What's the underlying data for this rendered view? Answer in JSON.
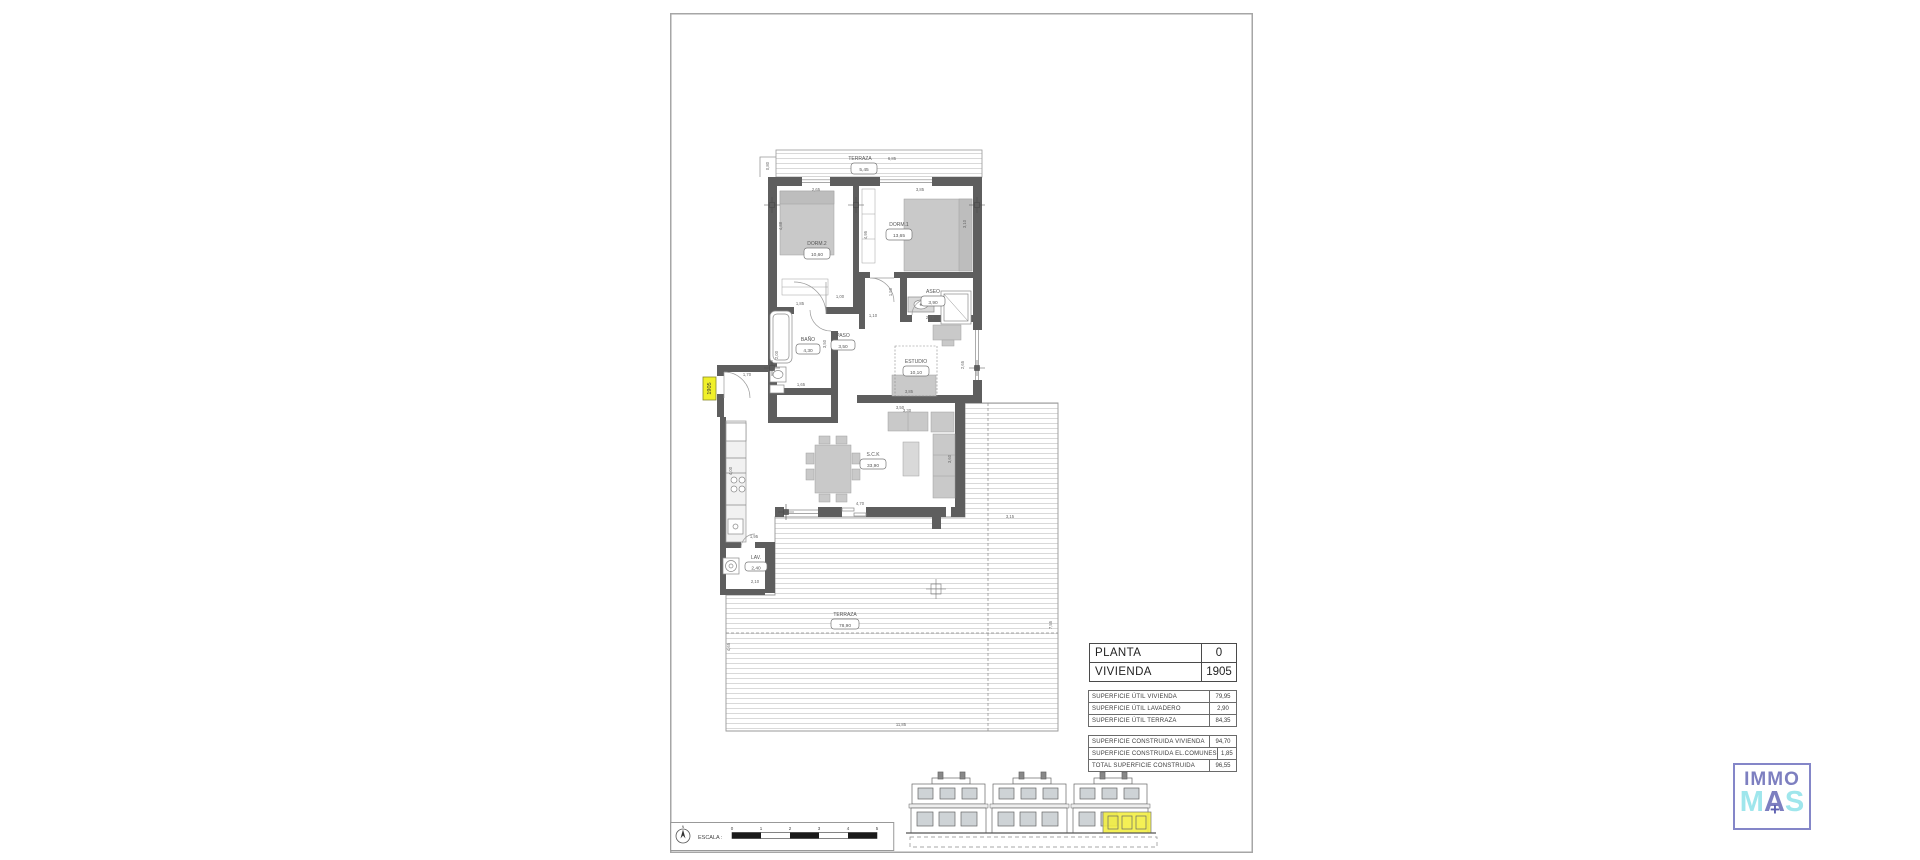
{
  "colors": {
    "wall": "#5e5e5e",
    "furniture": "#c9c9c9",
    "highlight": "#f2ee3e",
    "logo_purple": "#7d7fc0",
    "logo_cyan": "#9fe6ec"
  },
  "plan": {
    "unit_tag": "1905",
    "rooms": {
      "terraza_top": {
        "name": "TERRAZA",
        "area": "5,45"
      },
      "dorm2": {
        "name": "DORM.2",
        "area": "10,60"
      },
      "dorm1": {
        "name": "DORM.1",
        "area": "13,65"
      },
      "aseo": {
        "name": "ASEO",
        "area": "3,90"
      },
      "bano": {
        "name": "BAÑO",
        "area": "4,30"
      },
      "paso": {
        "name": "PASO",
        "area": "3,50"
      },
      "estudio": {
        "name": "ESTUDIO",
        "area": "10,10"
      },
      "sck": {
        "name": "S.C.K",
        "area": "33,90"
      },
      "lav": {
        "name": "LAV.",
        "area": "2,40"
      },
      "terraza": {
        "name": "TERRAZA",
        "area": "78,90"
      }
    },
    "dims": {
      "t_top_w": "6,85",
      "t_top_step": "0,80",
      "dorm2_w": "2,65",
      "dorm1_w": "3,85",
      "dorm2_h": "4,88",
      "closet_h": "4,95",
      "dorm1_h": "3,10",
      "closet_w": "1,85",
      "hall_w": "1,00",
      "aseo_h": "1,50",
      "aseo_w": "2,70",
      "bano_h": "2,00",
      "paso_v": "3,50",
      "paso_t": "1,10",
      "bano_b": "1,65",
      "estudio_b": "3,85",
      "estudio_b2": "3,30",
      "estudio_r": "2,65",
      "sofa_t": "3,50",
      "sck_b": "4,70",
      "sck_r": "3,60",
      "kitchen_h": "4,00",
      "entry_w": "1,70",
      "lav_t": "1,95",
      "lav_b": "2,10",
      "terraza_b": "11,85",
      "terraza_rw": "3,15",
      "terraza_rh": "7,55",
      "terraza_lh": "4,65"
    }
  },
  "title_block": {
    "rows": [
      {
        "label": "PLANTA",
        "value": "0"
      },
      {
        "label": "VIVIENDA",
        "value": "1905"
      }
    ]
  },
  "surface_tables": {
    "util": [
      {
        "label": "SUPERFICIE ÚTIL VIVIENDA",
        "value": "79,95"
      },
      {
        "label": "SUPERFICIE ÚTIL LAVADERO",
        "value": "2,90"
      },
      {
        "label": "SUPERFICIE ÚTIL TERRAZA",
        "value": "84,35"
      }
    ],
    "construida": [
      {
        "label": "SUPERFICIE CONSTRUIDA VIVIENDA",
        "value": "94,70"
      },
      {
        "label": "SUPERFICIE CONSTRUIDA EL.COMUNES",
        "value": "1,85"
      },
      {
        "label": "TOTAL SUPERFICIE CONSTRUIDA",
        "value": "96,55"
      }
    ]
  },
  "scale_bar": {
    "label": "ESCALA :",
    "north": "N",
    "ticks": [
      "0",
      "1",
      "2",
      "3",
      "4",
      "5"
    ]
  },
  "logo": {
    "top": "IMMO",
    "m": "M",
    "a": "A",
    "s": "S",
    "plus": "+"
  }
}
